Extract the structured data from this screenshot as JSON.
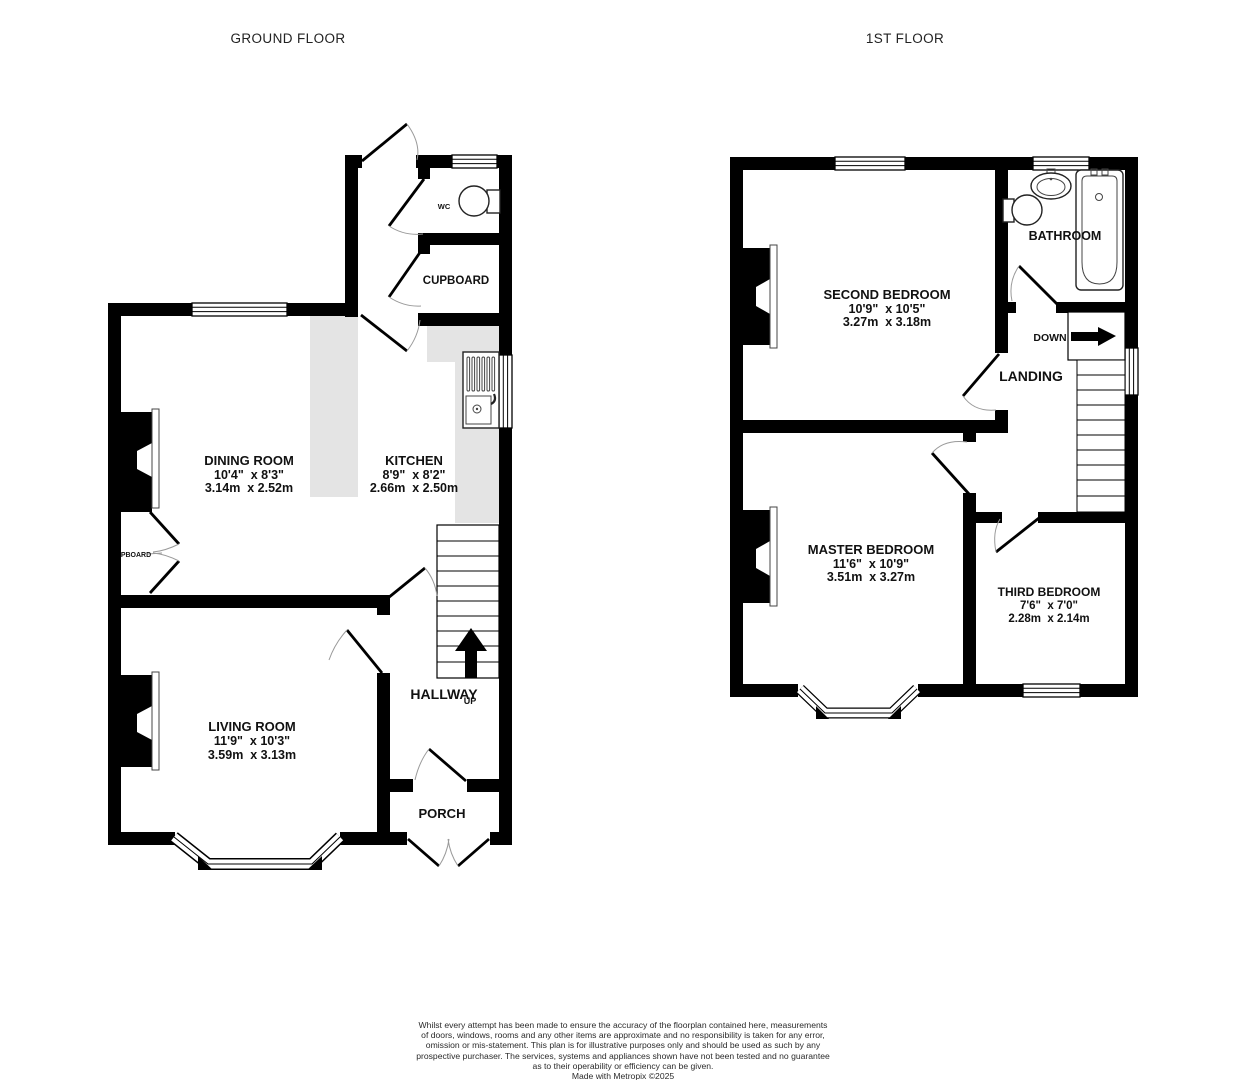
{
  "colors": {
    "wall": "#000000",
    "counter": "#e4e4e4",
    "arc": "#9a9a9a",
    "text": "#111111"
  },
  "titles": {
    "ground": "GROUND FLOOR",
    "first": "1ST FLOOR"
  },
  "ground": {
    "dining": {
      "name": "DINING ROOM",
      "imperial": "10'4\"  x 8'3\"",
      "metric": "3.14m  x 2.52m"
    },
    "kitchen": {
      "name": "KITCHEN",
      "imperial": "8'9\"  x 8'2\"",
      "metric": "2.66m  x 2.50m"
    },
    "living": {
      "name": "LIVING ROOM",
      "imperial": "11'9\"  x 10'3\"",
      "metric": "3.59m  x 3.13m"
    },
    "hallway": "HALLWAY",
    "up": "UP",
    "porch": "PORCH",
    "cupboard": "CUPBOARD",
    "wc": "WC",
    "pboard": "PBOARD"
  },
  "first": {
    "second": {
      "name": "SECOND BEDROOM",
      "imperial": "10'9\"  x 10'5\"",
      "metric": "3.27m  x 3.18m"
    },
    "master": {
      "name": "MASTER BEDROOM",
      "imperial": "11'6\"  x 10'9\"",
      "metric": "3.51m  x 3.27m"
    },
    "third": {
      "name": "THIRD BEDROOM",
      "imperial": "7'6\"  x 7'0\"",
      "metric": "2.28m  x 2.14m"
    },
    "bathroom": "BATHROOM",
    "landing": "LANDING",
    "down": "DOWN"
  },
  "disclaimer": {
    "lines": [
      "Whilst every attempt has been made to ensure the accuracy of the floorplan contained here, measurements",
      "of doors, windows, rooms and any other items are approximate and no responsibility is taken for any error,",
      "omission or mis-statement. This plan is for illustrative purposes only and should be used as such by any",
      "prospective purchaser. The services, systems and appliances shown have not been tested and no guarantee",
      "as to their operability or efficiency can be given.",
      "Made with Metropix ©2025"
    ]
  }
}
